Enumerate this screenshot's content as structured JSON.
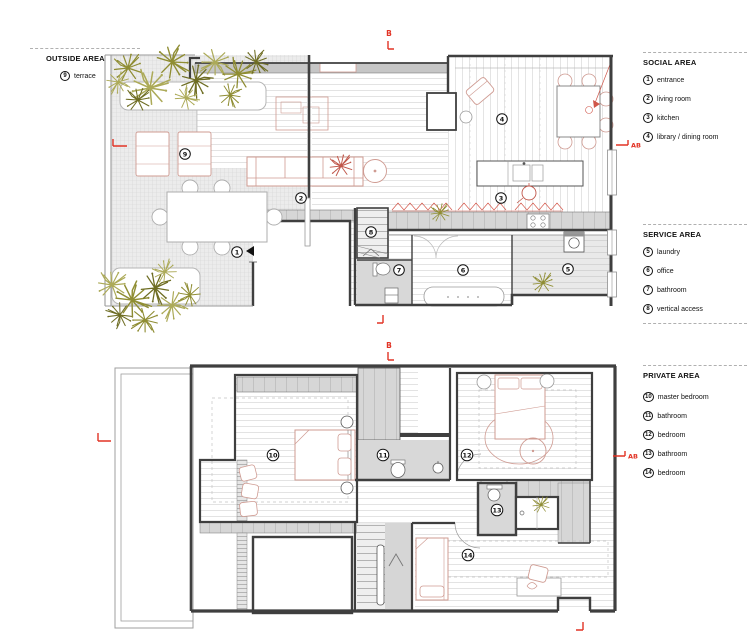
{
  "legend_left": {
    "title": "OUTSIDE AREA",
    "items": [
      {
        "num": "9",
        "label": "terrace"
      }
    ]
  },
  "legend_right": {
    "social": {
      "title": "SOCIAL AREA",
      "items": [
        {
          "num": "1",
          "label": "entrance"
        },
        {
          "num": "2",
          "label": "living room"
        },
        {
          "num": "3",
          "label": "kitchen"
        },
        {
          "num": "4",
          "label": "library / dining room"
        }
      ]
    },
    "service": {
      "title": "SERVICE AREA",
      "items": [
        {
          "num": "5",
          "label": "laundry"
        },
        {
          "num": "6",
          "label": "office"
        },
        {
          "num": "7",
          "label": "bathroom"
        },
        {
          "num": "8",
          "label": "vertical access"
        }
      ]
    },
    "private": {
      "title": "PRIVATE AREA",
      "items": [
        {
          "num": "10",
          "label": "master bedroom"
        },
        {
          "num": "11",
          "label": "bathroom"
        },
        {
          "num": "12",
          "label": "bedroom"
        },
        {
          "num": "13",
          "label": "bathroom"
        },
        {
          "num": "14",
          "label": "bedroom"
        }
      ]
    }
  },
  "markers": {
    "section_b": "B",
    "section_ab": "AB"
  },
  "plan_labels": {
    "upper": [
      "9",
      "2",
      "1",
      "4",
      "3",
      "8",
      "7",
      "6",
      "5"
    ],
    "lower": [
      "10",
      "11",
      "12",
      "13",
      "14"
    ]
  },
  "colors": {
    "marker_red": "#e23325",
    "wall": "#3f3f3f",
    "furniture_outline": "#cf9b92",
    "plant_green": "#8f8d33"
  }
}
